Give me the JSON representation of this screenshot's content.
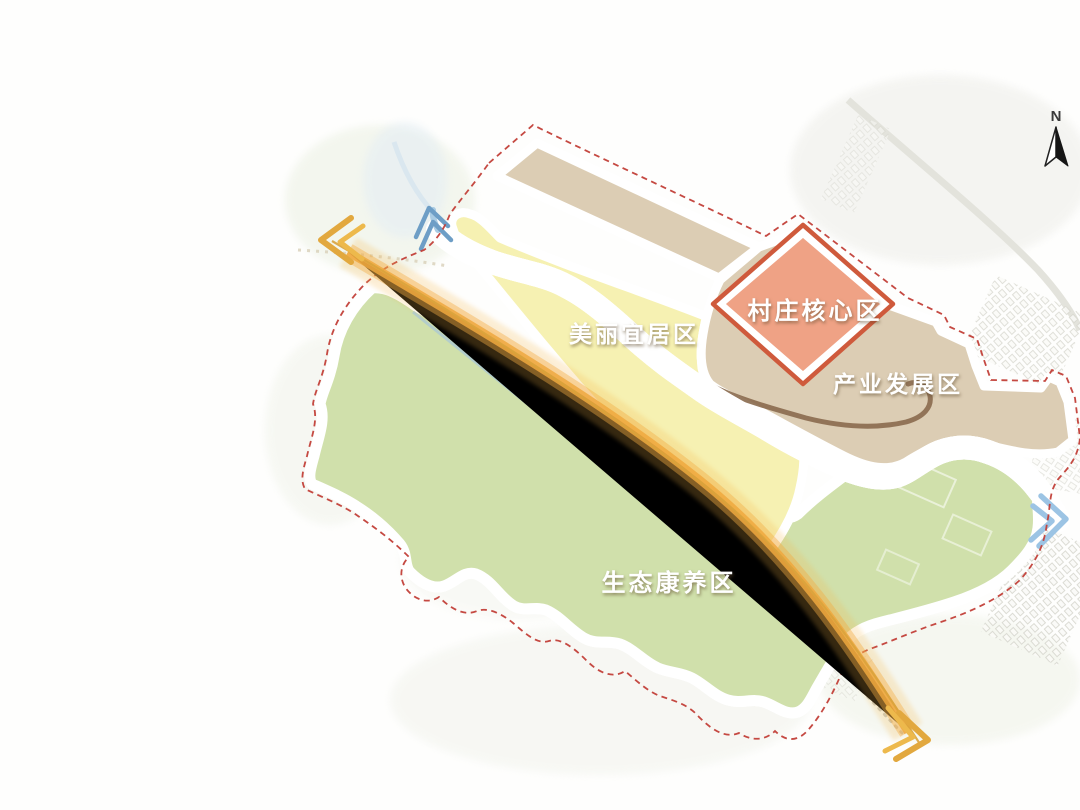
{
  "panel": {
    "title_line1": "一轴 一带",
    "title_line2": "四片区",
    "sections": [
      {
        "heading": "一轴:",
        "items": [
          "城镇发展轴"
        ]
      },
      {
        "heading": "一带:",
        "items": [
          "滨水景观形象带"
        ]
      },
      {
        "heading": "四片区:",
        "items": [
          "美丽宜居区",
          "产业发展区",
          "生态康养区",
          "村庄核心区"
        ]
      }
    ]
  },
  "map": {
    "north": "N",
    "labels": [
      {
        "text": "美丽宜居区"
      },
      {
        "text": "村庄核心区"
      },
      {
        "text": "产业发展区"
      },
      {
        "text": "生态康养区"
      }
    ],
    "colors": {
      "title_green": "#85B871",
      "box_border_green": "#9CC795",
      "zone_yellow": "#F6F1B2",
      "zone_yellow_border": "#EDD23F",
      "zone_green": "#D0E0AB",
      "zone_green_border": "#4A9150",
      "zone_tan": "#DCCDB4",
      "zone_tan_border": "#8A6A4E",
      "zone_salmon": "#EFA285",
      "zone_salmon_border": "#CF5A3C",
      "river_blue": "#A9CBE3",
      "axis_orange": "#EFA83E",
      "boundary_red_dash": "#C23F38"
    }
  }
}
